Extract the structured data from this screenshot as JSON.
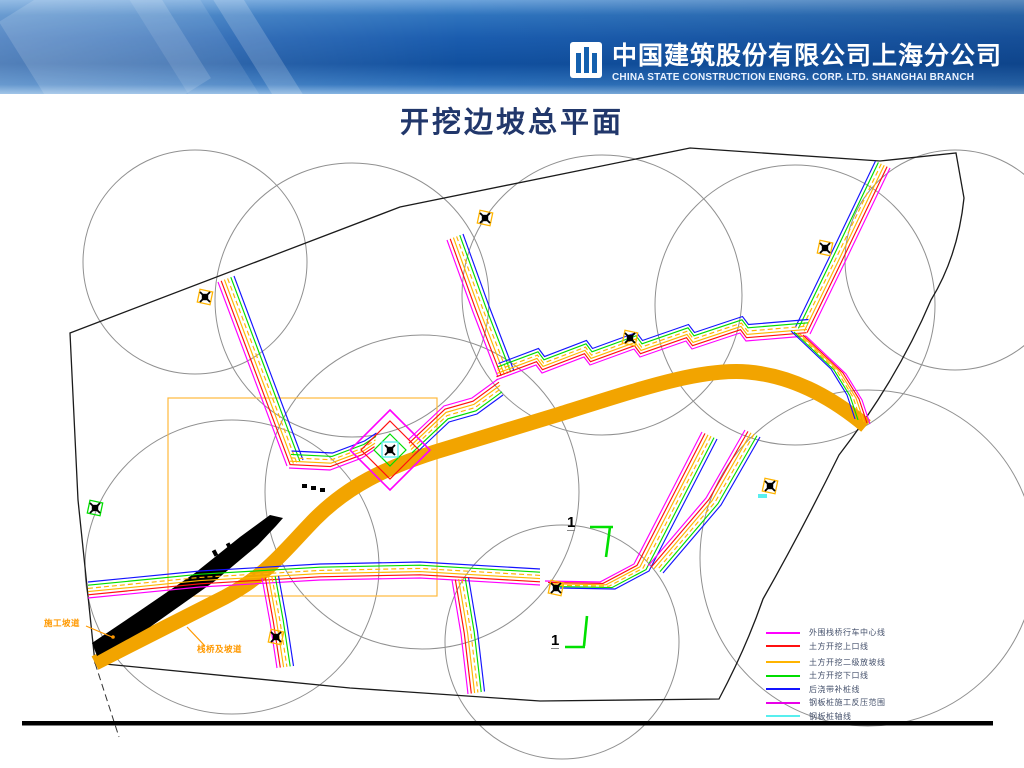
{
  "header": {
    "company_cn": "中国建筑股份有限公司上海分公司",
    "company_en": "CHINA STATE CONSTRUCTION ENGRG. CORP. LTD. SHANGHAI BRANCH",
    "logo": "CSCEC"
  },
  "title": "开挖边坡总平面",
  "drawing": {
    "bundle_colors": [
      "#FF00FF",
      "#FF1010",
      "#FFB400",
      "#FFB400",
      "#00DD00",
      "#1414FF"
    ],
    "road_color": "#F2A400",
    "ramp_color": "#000000",
    "boundary_color": "#1B1B1B",
    "circle_color": "#909090",
    "viewport_box_color": "#FFB93C",
    "section_markers": [
      {
        "label": "1"
      },
      {
        "label": "1"
      }
    ],
    "annotations": [
      {
        "label": "施工坡道",
        "color": "#FF9900"
      },
      {
        "label": "栈桥及坡道",
        "color": "#FF9900"
      }
    ]
  },
  "legend": {
    "items": [
      {
        "label": "外围栈桥行车中心线",
        "color": "#FF00FF"
      },
      {
        "label": "土方开挖上口线",
        "color": "#FF1010"
      },
      {
        "label": "土方开挖二级放坡线",
        "color": "#FFB400"
      },
      {
        "label": "土方开挖下口线",
        "color": "#00DD00"
      },
      {
        "label": "后浇带补桩线",
        "color": "#1414FF"
      },
      {
        "label": "钢板桩施工反压范围",
        "color": "#E800E8"
      },
      {
        "label": "钢板桩轴线",
        "color": "#58EFEF"
      }
    ]
  }
}
